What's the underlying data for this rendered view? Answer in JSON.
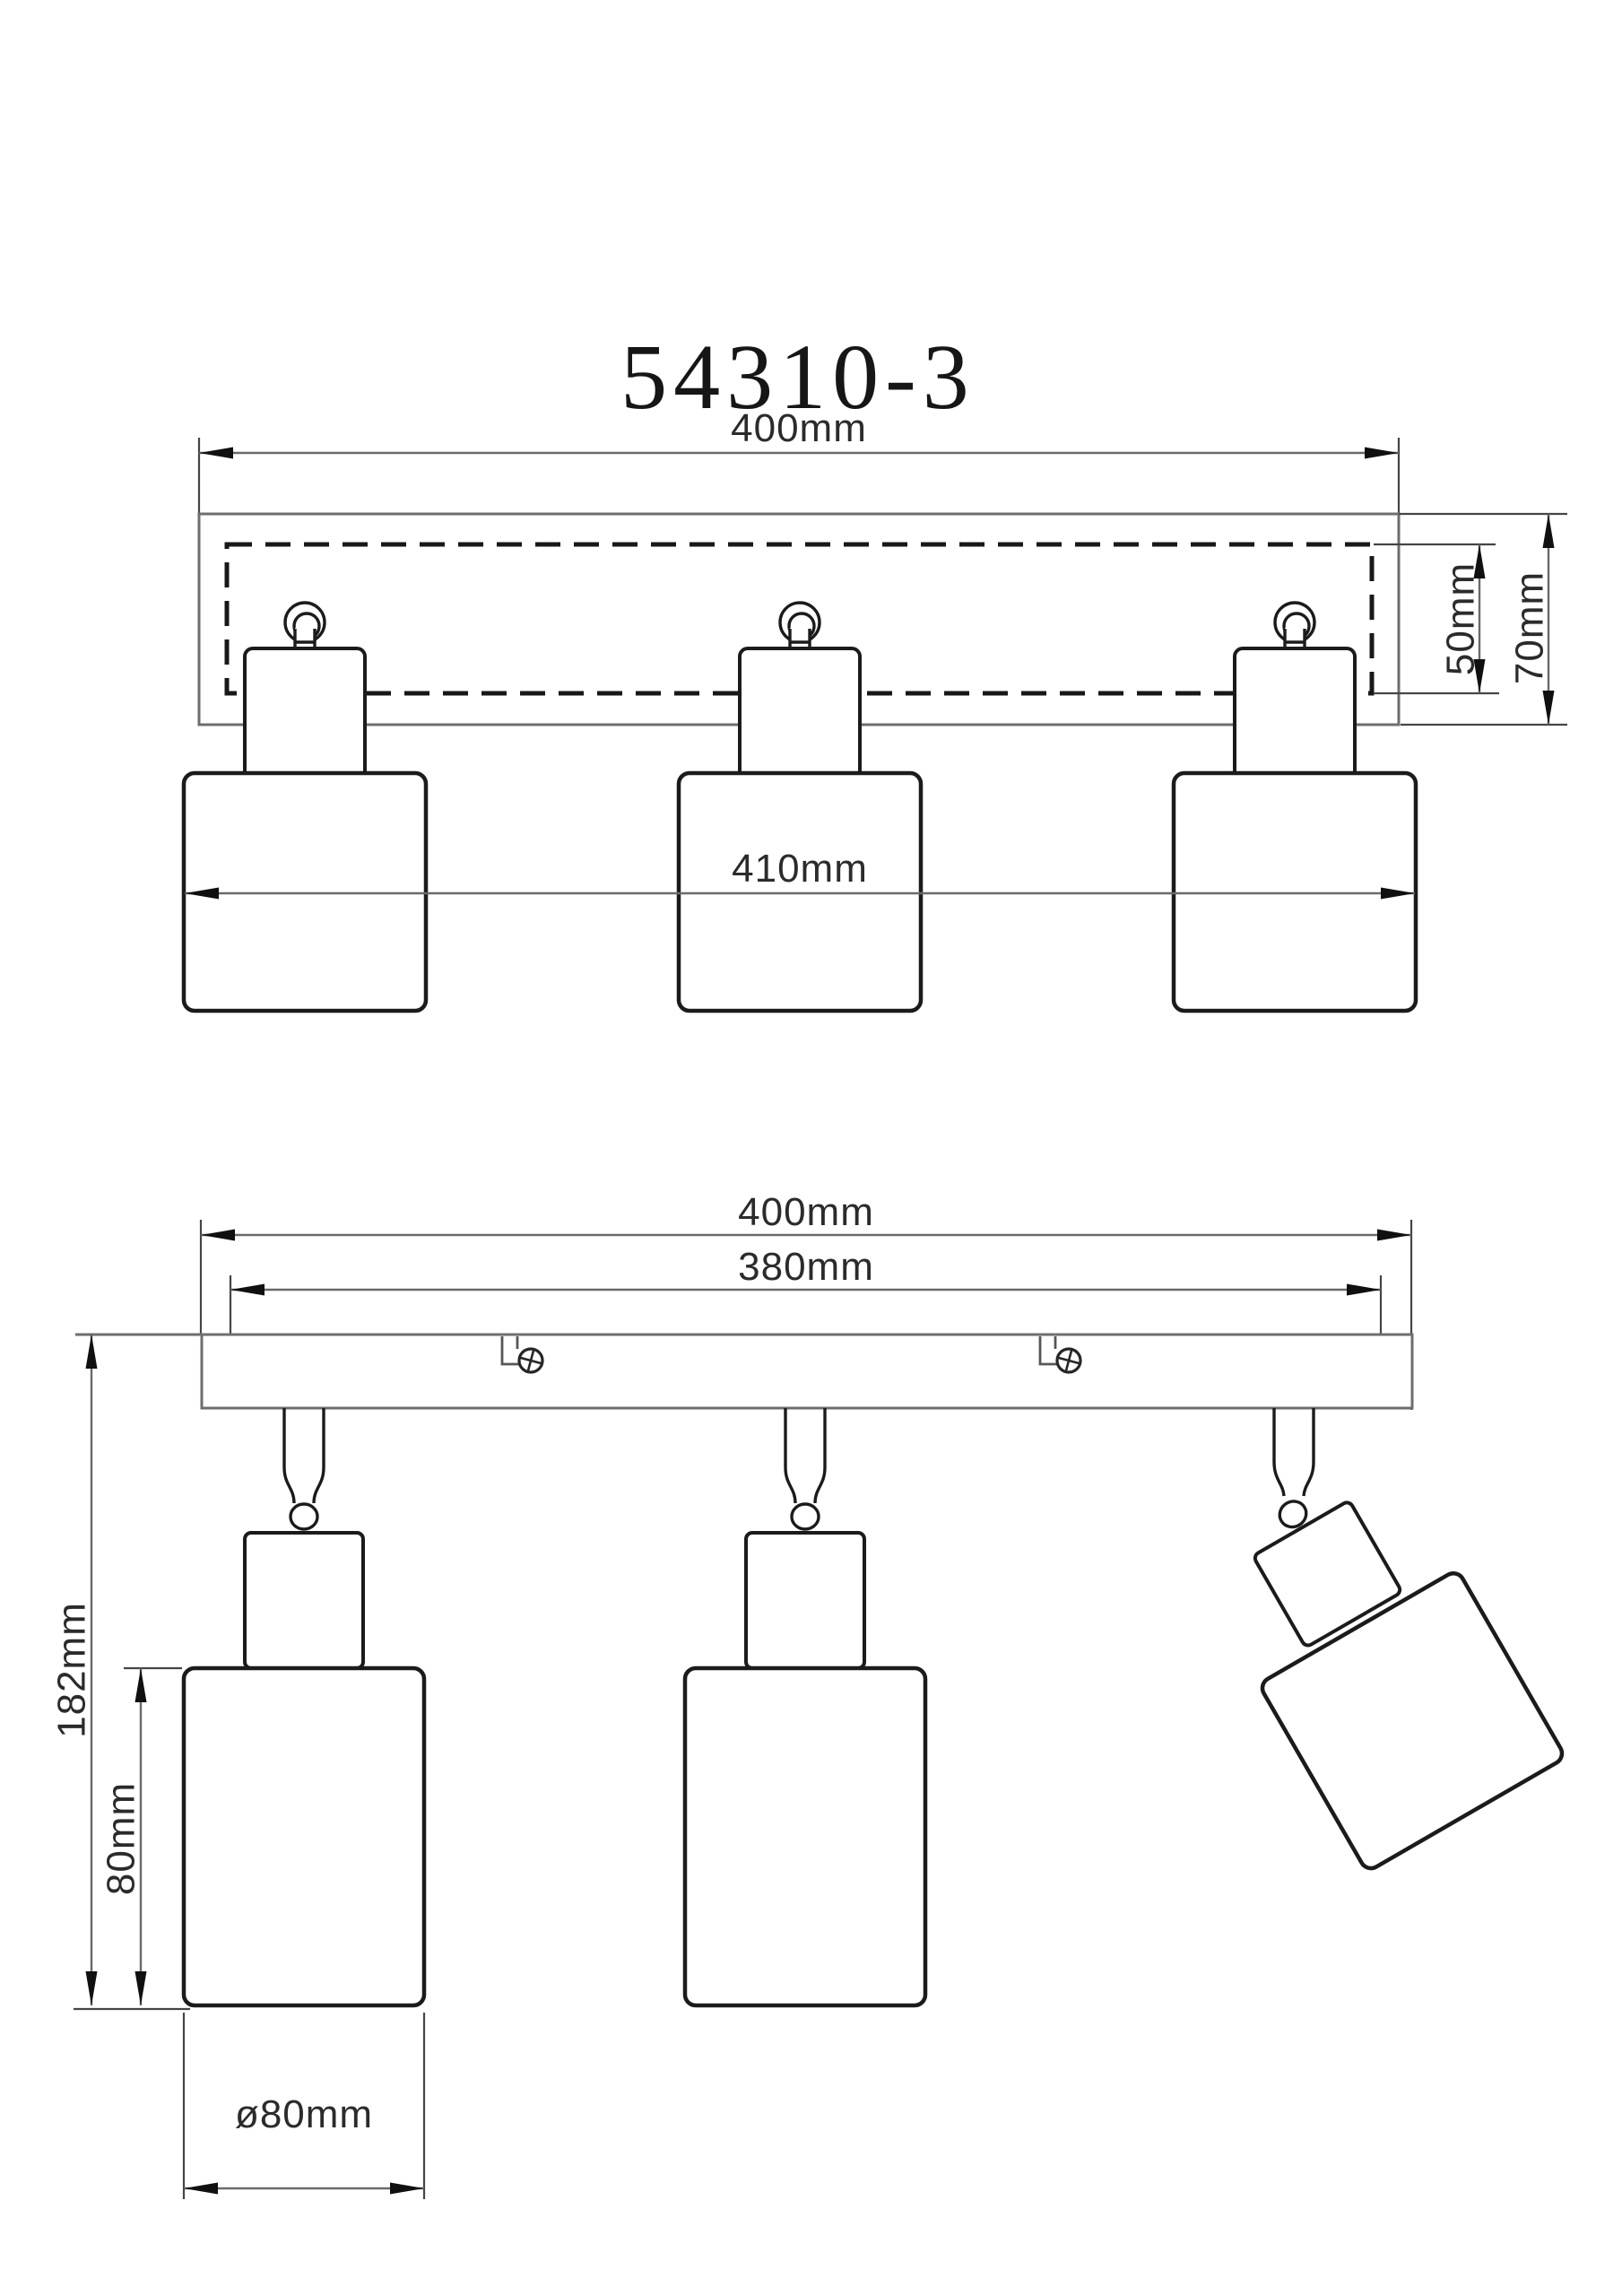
{
  "title": "54310-3",
  "top_view": {
    "width": "400mm",
    "recess_depth": "50mm",
    "overall_depth": "70mm",
    "fixture_span": "410mm"
  },
  "bottom_view": {
    "width": "400mm",
    "mounting_span": "380mm",
    "overall_height": "182mm",
    "shade_height": "80mm",
    "shade_diameter": "ø80mm"
  },
  "colors": {
    "background": "#ffffff",
    "outline_ink": "#1b1b1b",
    "bracket_gray": "#6e6e6e",
    "dimension_line": "#6a6a6a",
    "label_text": "#2b2b2b"
  },
  "icons": {
    "screw_icon": "phillips-cross-circle"
  }
}
